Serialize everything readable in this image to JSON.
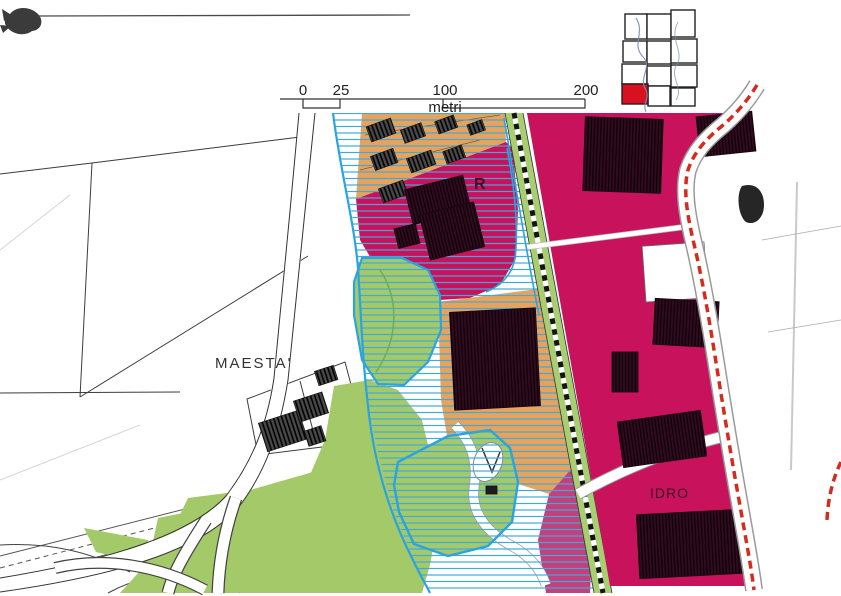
{
  "header": {
    "title": "Elaborato P.O.3",
    "subtitle": "rapporto 1:2.000",
    "scale_bar": {
      "tick_0": "0",
      "tick_25": "25",
      "tick_100": "100",
      "tick_200": "200",
      "unit": "metri"
    }
  },
  "signature": {
    "text": "Firmato Da: STEFANO LATTANZI Emesso Da: ARUBAPEC EU QUALIFIED CERTIFICATES CA G1 Serial#: fb6715e2b917b8"
  },
  "map": {
    "labels": {
      "locality": "MAESTA'",
      "zone_r": "R",
      "zone_idro": "IDRO"
    },
    "colors": {
      "magenta_zone": "#c8135c",
      "pink_zone": "#c2407c",
      "orange_zone": "#e7a25c",
      "park_green": "#a3c969",
      "railway_green": "#a9ce72",
      "hatch_blue": "#3fa9dc",
      "stream_blue": "#2aa4e0",
      "boundary_red": "#d42b1e",
      "index_red": "#d8101f",
      "building_dark": "#330a20"
    }
  }
}
